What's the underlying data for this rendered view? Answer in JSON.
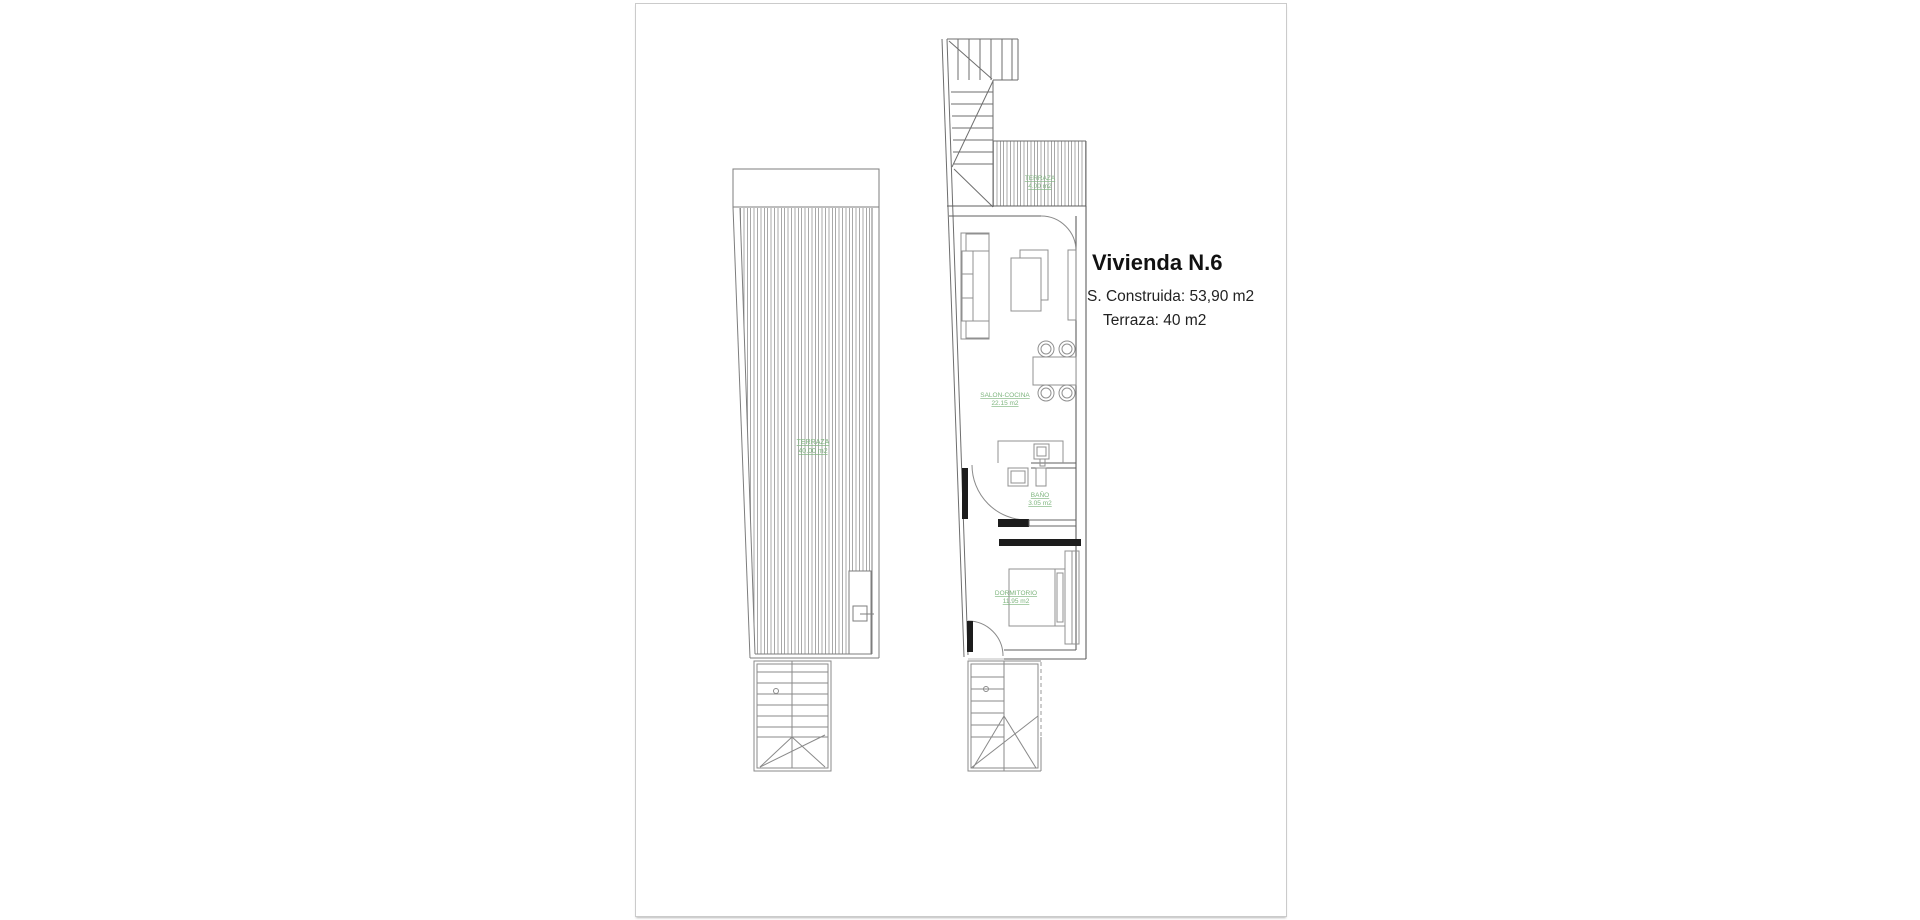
{
  "info": {
    "title": "Vivienda N.6",
    "built_area": "S. Construida: 53,90 m2",
    "terrace_area": "Terraza: 40 m2"
  },
  "plans": {
    "left": {
      "label": {
        "name": "TERRAZA",
        "area": "40.00 m2"
      }
    },
    "right": {
      "terrace": {
        "name": "TERRAZA",
        "area": "4.00 m2"
      },
      "living": {
        "name": "SALON-COCINA",
        "area": "22.15 m2"
      },
      "bath": {
        "name": "BAÑO",
        "area": "3.05 m2"
      },
      "bedroom": {
        "name": "DORMITORIO",
        "area": "11.95 m2"
      }
    }
  },
  "colors": {
    "label_green": "#7eb57e",
    "line_gray": "#8a8a8a",
    "wall_gray": "#5f5f5f",
    "hatch_gray": "#a8a8a8",
    "text_dark": "#1c1c1c"
  }
}
